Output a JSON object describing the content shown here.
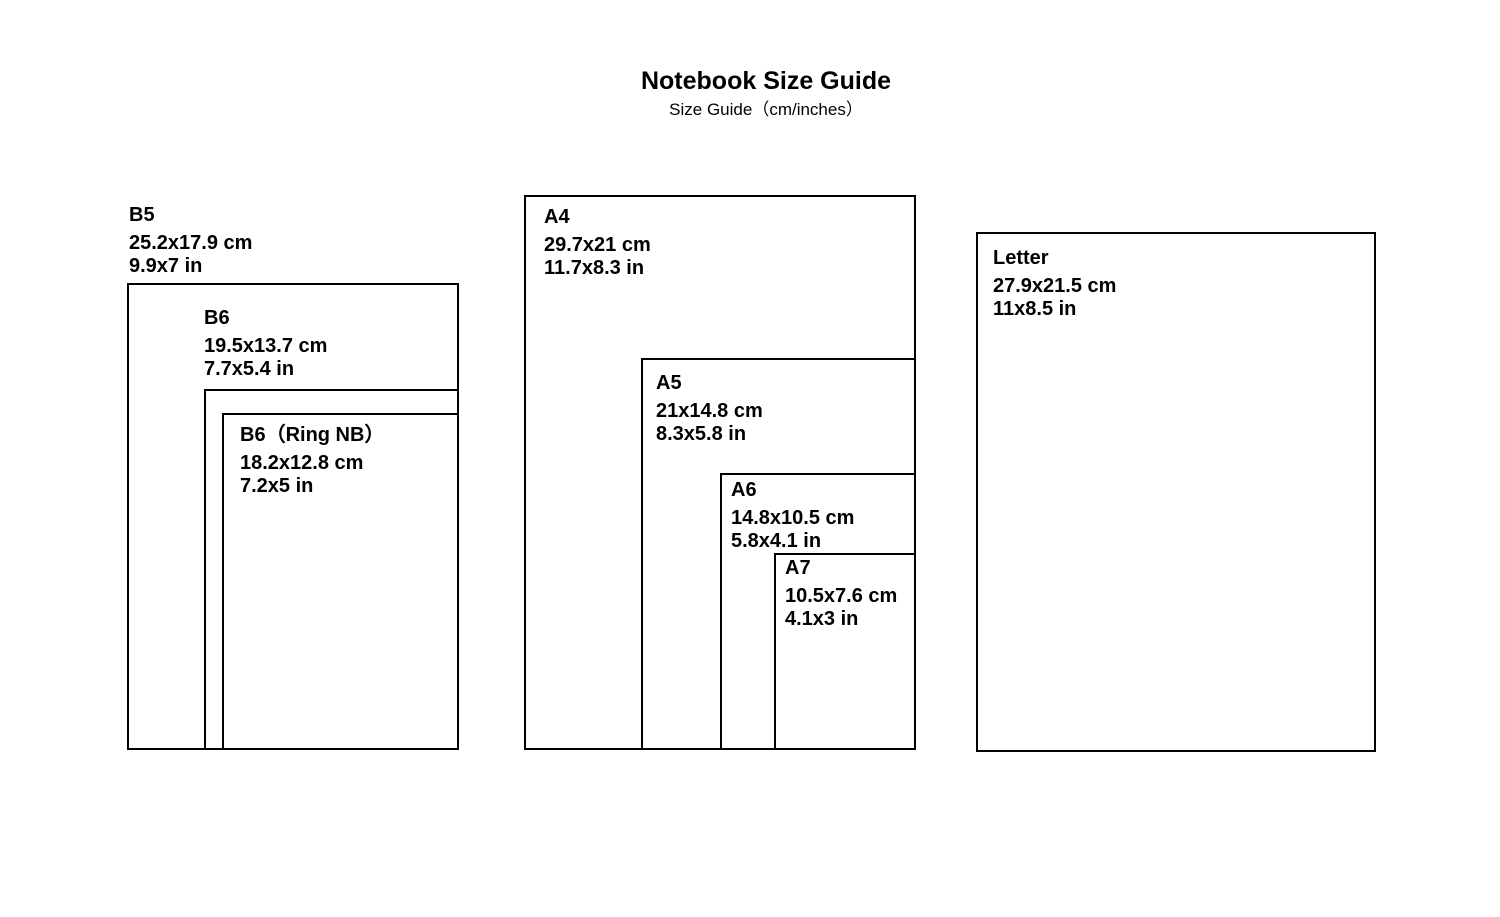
{
  "title": "Notebook Size Guide",
  "subtitle": "Size Guide（cm/inches）",
  "colors": {
    "background": "#ffffff",
    "line": "#000000",
    "text": "#000000"
  },
  "sizes": [
    {
      "id": "b5",
      "name": "B5",
      "cm": "25.2x17.9 cm",
      "inches": "9.9x7 in"
    },
    {
      "id": "b6",
      "name": "B6",
      "cm": "19.5x13.7 cm",
      "inches": "7.7x5.4 in"
    },
    {
      "id": "b6-ring",
      "name": "B6（Ring NB）",
      "cm": "18.2x12.8 cm",
      "inches": "7.2x5 in"
    },
    {
      "id": "a4",
      "name": "A4",
      "cm": "29.7x21 cm",
      "inches": "11.7x8.3 in"
    },
    {
      "id": "a5",
      "name": "A5",
      "cm": "21x14.8 cm",
      "inches": "8.3x5.8 in"
    },
    {
      "id": "a6",
      "name": "A6",
      "cm": "14.8x10.5 cm",
      "inches": "5.8x4.1 in"
    },
    {
      "id": "a7",
      "name": "A7",
      "cm": "10.5x7.6 cm",
      "inches": "4.1x3 in"
    },
    {
      "id": "letter",
      "name": "Letter",
      "cm": "27.9x21.5 cm",
      "inches": "11x8.5 in"
    }
  ]
}
